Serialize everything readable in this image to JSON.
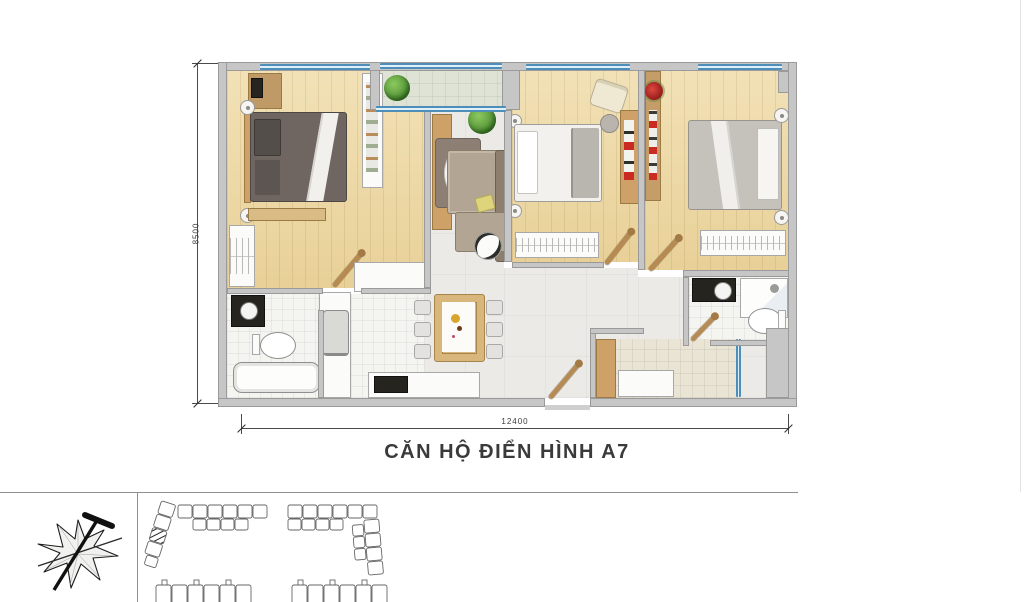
{
  "title": "CĂN HỘ ĐIỂN HÌNH A7",
  "dimensions": {
    "width_label": "12400",
    "height_label": "8500"
  },
  "floorplan": {
    "rooms": [
      "bedroom-1",
      "bedroom-2",
      "bedroom-3",
      "living-room",
      "dining-area",
      "kitchen",
      "bathroom-1",
      "bathroom-2",
      "balcony",
      "entry-hall"
    ],
    "colors": {
      "wall": "#c6c6c6",
      "wood_floor": "#eed9a2",
      "tile_floor": "#ebeae7",
      "balcony_tile": "#dee3d6",
      "entry_tile": "#e9e4d4",
      "window_blue": "#4d8fb8",
      "bed_dark": "#6f6561",
      "sofa": "#b2a593",
      "accent_red": "#c0221d",
      "plant_green": "#57963a"
    }
  },
  "site_plan": {
    "buildings": [
      "l-shaped-top-left",
      "l-shaped-top-right",
      "row-bottom-left",
      "row-bottom-right"
    ],
    "marked_unit": "hatched unit in top-left building"
  },
  "icons": [
    "north-arrow-compass-icon"
  ]
}
